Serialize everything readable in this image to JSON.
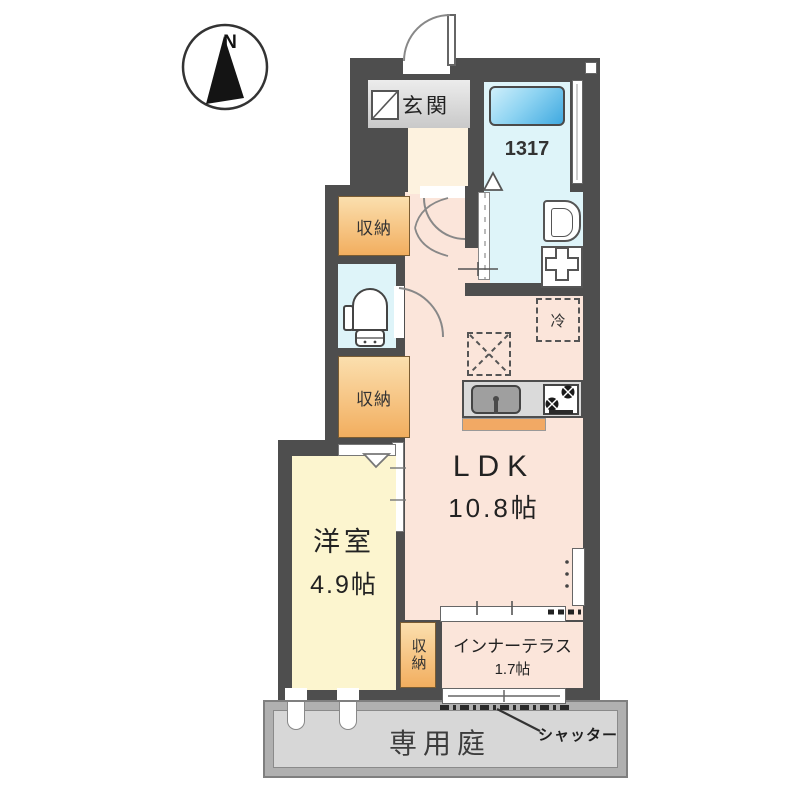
{
  "compass": {
    "north": "N"
  },
  "rooms": {
    "entrance": {
      "label": "玄関"
    },
    "bathroom": {
      "size": "1317"
    },
    "storage_upper": {
      "label": "収納"
    },
    "storage_middle": {
      "label": "収納"
    },
    "storage_terrace": {
      "label": "収納"
    },
    "ldk": {
      "label": "LDK",
      "size": "10.8帖"
    },
    "western_room": {
      "label": "洋室",
      "size": "4.9帖"
    },
    "inner_terrace": {
      "label": "インナーテラス",
      "size": "1.7帖"
    },
    "garden": {
      "label": "専用庭"
    },
    "refrigerator_space": {
      "label": "冷"
    }
  },
  "annotations": {
    "shutter": "シャッター"
  },
  "colors": {
    "wall": "#4e4e4e",
    "ldk_fill": "#fbe5da",
    "western_room_fill": "#fcf5cf",
    "wet_area_fill": "#def4f9",
    "storage_fill": "#f2ae5f",
    "entrance_fill": "#d9d9d9",
    "garden_fill": "#d7d7d7",
    "bathtub_fill": "#3fa9e0",
    "counter_accent": "#f2a964"
  }
}
